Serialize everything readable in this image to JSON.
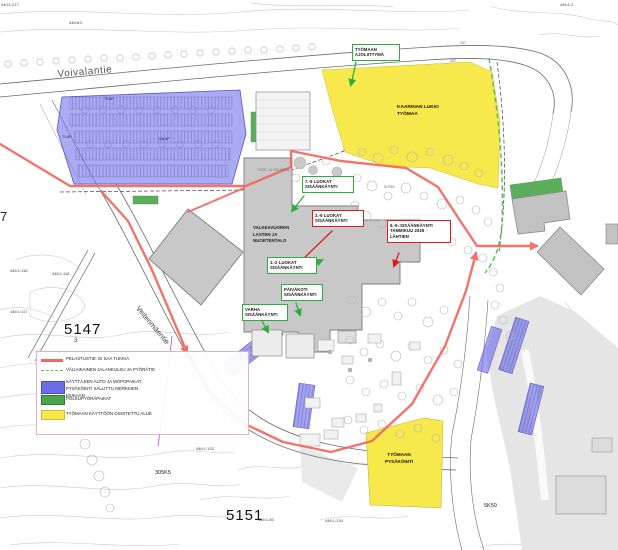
{
  "colors": {
    "rescue_red": "#f2685f",
    "callout_red": "#e01b1b",
    "callout_green": "#2fae3f",
    "parking_blue": "#6b6be4",
    "bike_green": "#4aa54a",
    "worksite_yellow": "#f7e84b"
  },
  "legend": {
    "items": [
      {
        "label": "PELASTUSTIE. EI SAA TUKKIA",
        "swatch": "line-red"
      },
      {
        "label": "VÄLIAIKAINEN JALANKULKU JA PYÖRÄTIE",
        "swatch": "line-green-dashed"
      },
      {
        "label": "KÄYTTÄJIEN AUTO JA MOPOPAIKAT.\nPYSÄKÖINTI SALLITTU MERKKIEN\nMUKAAN",
        "swatch": "area-blue"
      },
      {
        "label": "POLKUPYÖRÄPAIKAT",
        "swatch": "area-green"
      },
      {
        "label": "TYÖMAAN KÄYTTÖÖN OSOITETTU ALUE",
        "swatch": "area-yellow"
      }
    ]
  },
  "map": {
    "streets": {
      "voivalantie": "Voivalantie",
      "veitenmaentie": "Veitenmäentie"
    },
    "areas": {
      "kaarinan_lukio_tyomaa": "KAARINAN LUKIO\nTYÖMAA",
      "tyomaan_pysakointi": "TYÖMAAN\nPYSÄKÖINTI",
      "valkeavuoren_talo": "VALKEAVUOREN\nLASTEN JA\nNUORTENTALO"
    },
    "callouts": {
      "tyomaan_ajoliittyma": "TYÖMAAN\nAJOLIITTYMÄ",
      "luokat_7_9": "7.-9 LUOKAT\nSISÄÄNKÄYNTI",
      "luokat_3_6": "3.-6 LUOKAT\nSISÄÄNKÄYNTI",
      "sisaankaynti_5_9": "5.-9. SISÄÄNKÄYNTI\nTAMMIKUU 2026\nLÄHTIEN",
      "luokat_1_2": "1.-2 LUOKAT\nSISÄÄNKÄYNTI",
      "paivakoti": "PÄIVÄKOTI\nSISÄÄNKÄYNTI",
      "varha": "VARHA\nSISÄÄNKÄYNTI"
    },
    "parcels": {
      "p440_1_217": "440:1:217",
      "p446_8_0": "446:8:0",
      "p247a": "247",
      "p247b": "247",
      "p446_1_2": "446:1:2",
      "big7": "7",
      "p446_1_118": "446:1:118",
      "p446_1_116": "446:1:116",
      "p446_1_117": "446:1:117",
      "p446_1_18": "446:1:18",
      "big5147": "5147",
      "sub3": "3",
      "p446_1_132": "446:1:132",
      "p305K5": "305K5",
      "big5151": "5151",
      "p446_1_46": "446:1:46",
      "p446_1_134": "446:1:134",
      "p5K50": "5K50"
    },
    "parking_counts": {
      "p73": "73 AP",
      "p71": "71 AP",
      "p128": "128 AP"
    },
    "small_labels": {
      "nurmi": "NURMI",
      "tiede_piha": "TIEDE- JA TAIDEPIHA"
    }
  }
}
